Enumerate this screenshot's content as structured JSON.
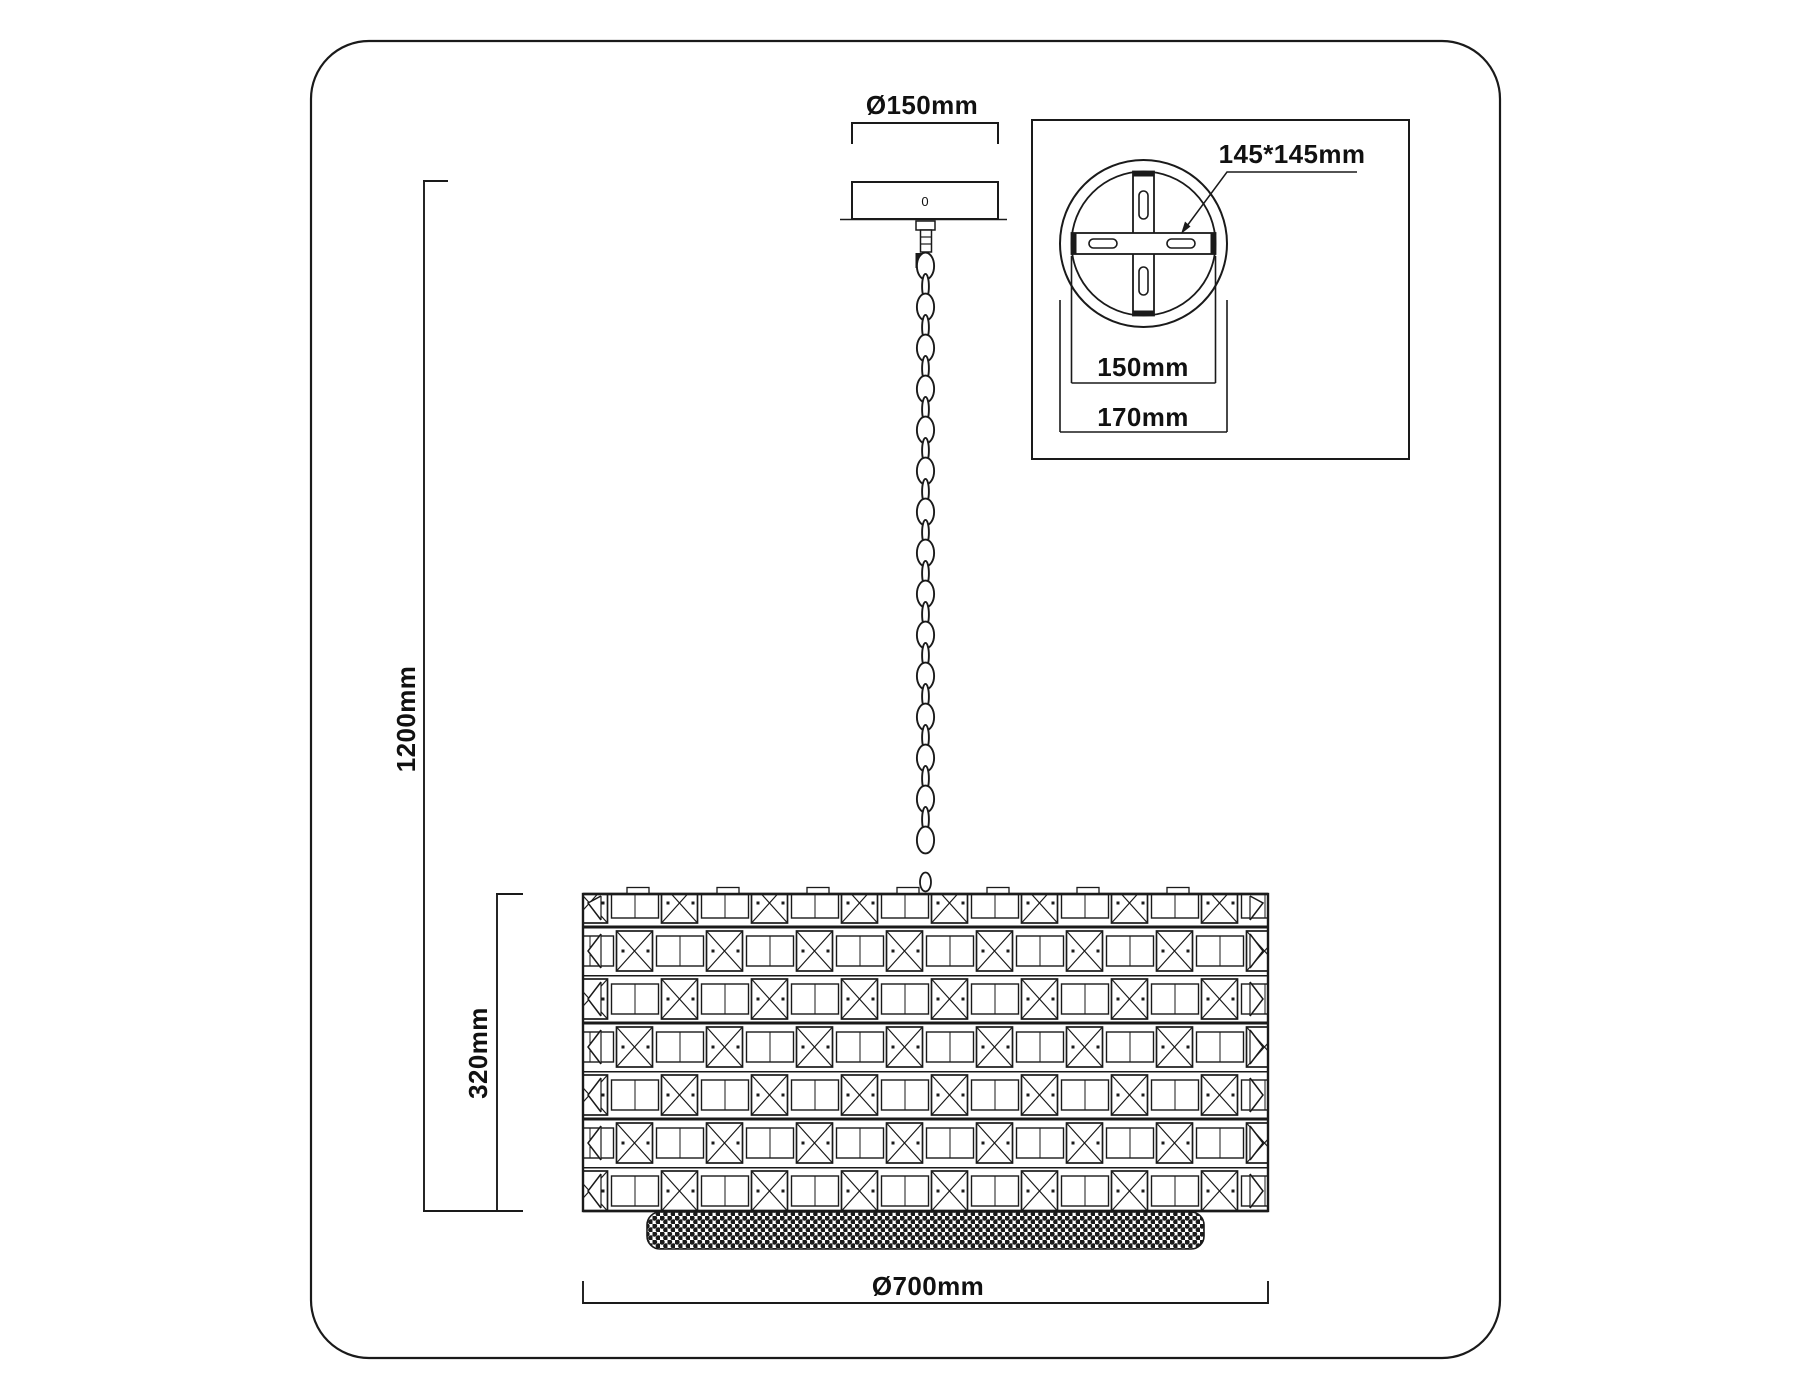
{
  "page": {
    "background": "#ffffff",
    "ink": "#1a1a1a",
    "text_color": "#111111"
  },
  "diagram": {
    "title": "pendant chandelier dimension drawing",
    "main_view": {
      "canopy_diameter_label": "Ø150mm",
      "canopy_mark": "0",
      "overall_height_label": "1200mm",
      "shade_height_label": "320mm",
      "shade_diameter_label": "Ø700mm"
    },
    "inset_view": {
      "bracket_label": "145*145mm",
      "canopy_inner_label": "150mm",
      "canopy_outer_label": "170mm"
    }
  }
}
